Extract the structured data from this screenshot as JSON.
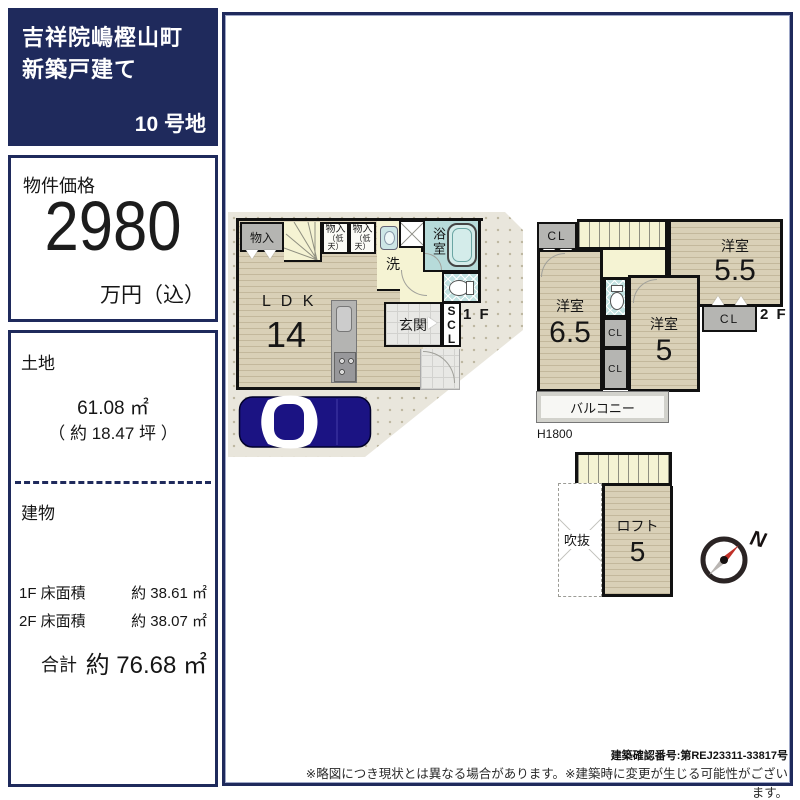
{
  "title_box": {
    "line1": "吉祥院嶋樫山町",
    "line2": "新築戸建て",
    "lot_number": "10 号地"
  },
  "price_box": {
    "label": "物件価格",
    "amount": "2980",
    "unit": "万円（込）"
  },
  "land_box": {
    "heading": "土地",
    "area": "61.08 ㎡",
    "area_tsubo": "（ 約 18.47 坪 ）"
  },
  "building_box": {
    "heading": "建物",
    "floor1_label": "1F 床面積",
    "floor1_value": "約 38.61 ㎡",
    "floor2_label": "2F 床面積",
    "floor2_value": "約 38.07 ㎡",
    "total_label": "合計",
    "total_value": "約 76.68 ㎡"
  },
  "floor1": {
    "tag": "1 F",
    "ldk": "L D K",
    "ldk_size": "14",
    "closet": "物入",
    "closet_low_line1": "物入",
    "closet_low_line2": "（低天）",
    "washroom": "洗面",
    "bathroom": "浴室",
    "entrance": "玄関",
    "shoe_closet": "SCL"
  },
  "floor2": {
    "tag": "2 F",
    "closet": "CL",
    "room": "洋室",
    "room1_size": "5.5",
    "room2_size": "6.5",
    "room3_size": "5",
    "balcony": "バルコニー",
    "balcony_height": "H1800"
  },
  "loft": {
    "room": "ロフト",
    "size": "5",
    "void": "吹抜"
  },
  "compass": {
    "north": "N"
  },
  "footer": {
    "confirmation_number": "建築確認番号:第REJ23311-33817号",
    "disclaimer": "※略図につき現状とは異なる場合があります。※建築時に変更が生じる可能性がございます。"
  },
  "colors": {
    "navy": "#1f2a5c",
    "wall": "#111111",
    "wood_floor": "#d8cfb6",
    "stair_yellow": "#f4f2d3",
    "bath_blue": "#b7dbda",
    "lot_beige": "#e9e6dc",
    "car_navy": "#1b1383",
    "closet_gray": "#b5b5b2"
  }
}
